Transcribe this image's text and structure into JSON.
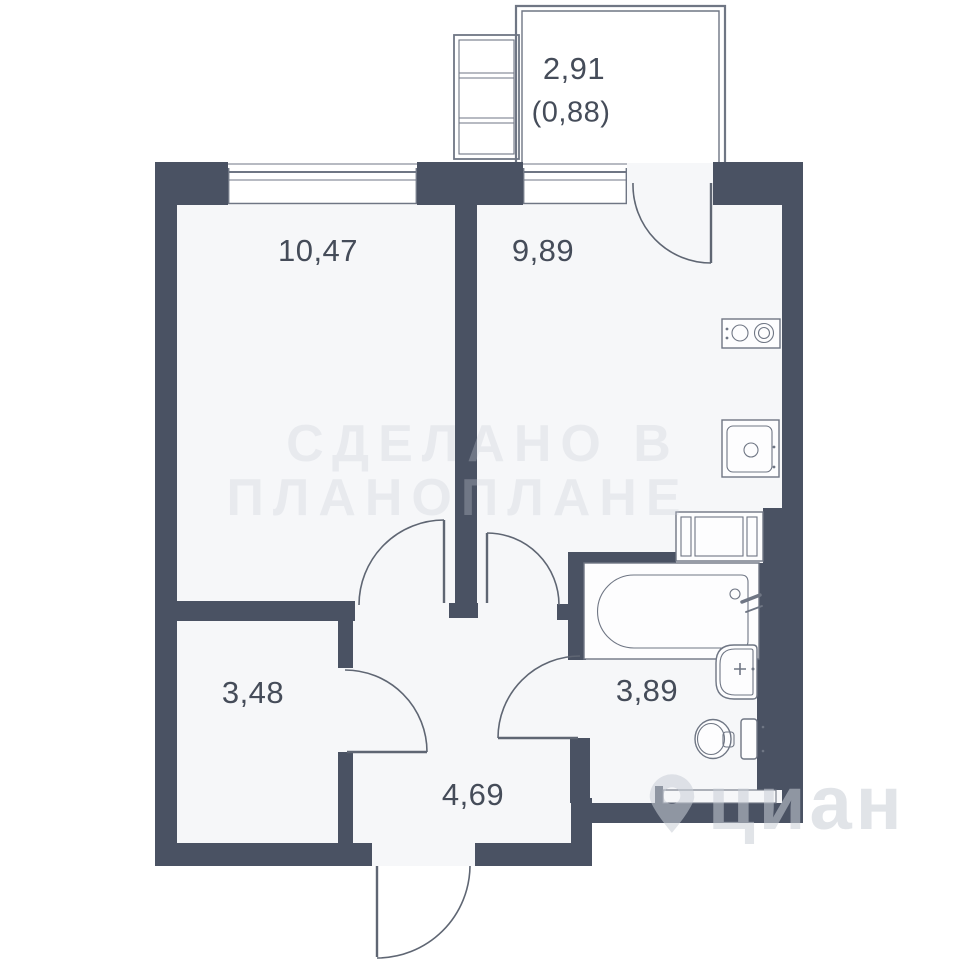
{
  "colors": {
    "paper": "#ffffff",
    "floor": "#f6f7f9",
    "wall": "#4a5263",
    "line": "#6f7684",
    "door": "#5f6673",
    "label": "#454c59",
    "wm": "#c9ced7"
  },
  "rooms": [
    {
      "name": "room",
      "area_label": "10,47"
    },
    {
      "name": "kitchen",
      "area_label": "9,89"
    },
    {
      "name": "balcony",
      "area_label": "2,91",
      "area_reduced": "(0,88)"
    },
    {
      "name": "storage",
      "area_label": "3,48"
    },
    {
      "name": "hallway",
      "area_label": "4,69"
    },
    {
      "name": "bathroom",
      "area_label": "3,89"
    }
  ],
  "fixtures": [
    "window",
    "window",
    "balcony-door",
    "room-door",
    "kitchen-door",
    "storage-door",
    "bathroom-door",
    "entry-door",
    "stove",
    "kitchen-sink",
    "washing-machine",
    "bathtub",
    "washbasin",
    "toilet",
    "storage-shelf"
  ],
  "watermarks": {
    "maker_line1": "СДЕЛАНО В",
    "maker_line2": "ПЛАНОПЛАНЕ",
    "brand": "циан",
    "brand_icon": "map-pin-icon"
  }
}
